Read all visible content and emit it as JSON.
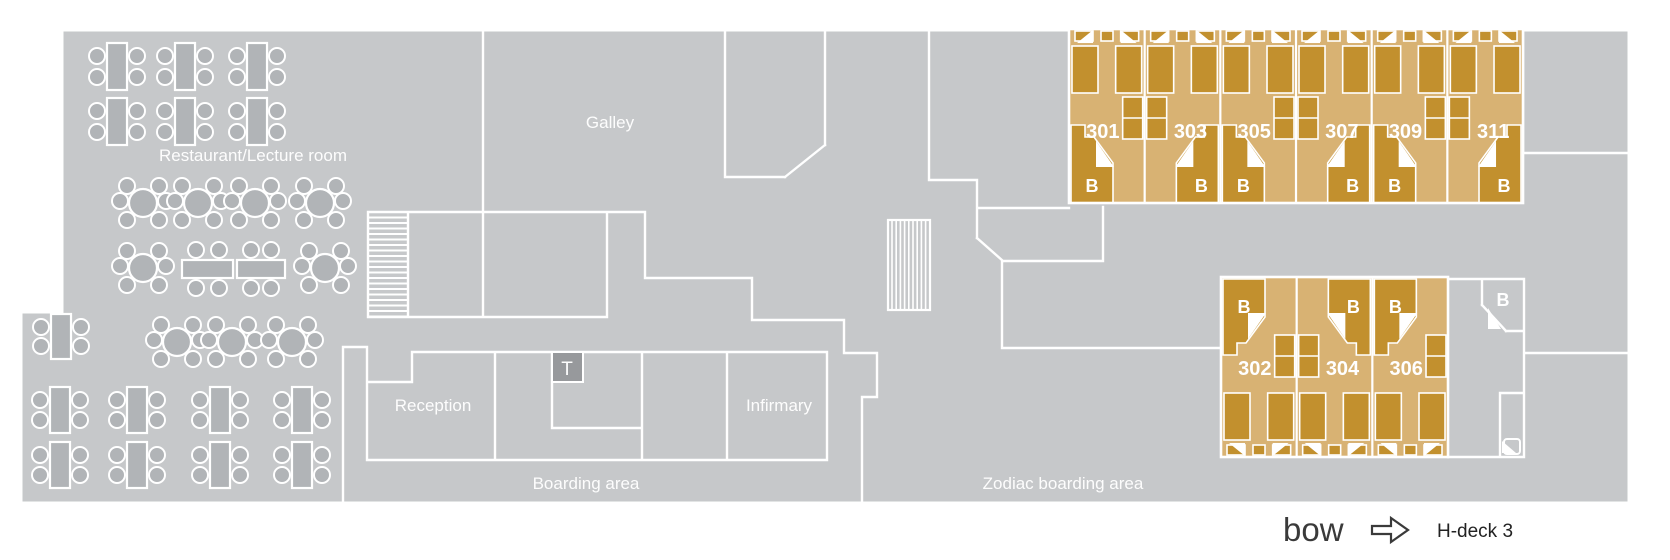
{
  "plan_title": "H-deck 3",
  "rooms": {
    "restaurant": "Restaurant/Lecture room",
    "galley": "Galley",
    "reception": "Reception",
    "toilet": "T",
    "infirmary": "Infirmary",
    "boarding": "Boarding area",
    "zodiac": "Zodiac boarding area"
  },
  "cabins": {
    "bathroom_label": "B",
    "top_row": [
      {
        "number": "301",
        "bath_side": "left",
        "table_side": "right"
      },
      {
        "number": "303",
        "bath_side": "right",
        "table_side": "left"
      },
      {
        "number": "305",
        "bath_side": "left",
        "table_side": "right"
      },
      {
        "number": "307",
        "bath_side": "right",
        "table_side": "left"
      },
      {
        "number": "309",
        "bath_side": "left",
        "table_side": "right"
      },
      {
        "number": "311",
        "bath_side": "right",
        "table_side": "left"
      }
    ],
    "bottom_row": [
      {
        "number": "302",
        "bath_side": "left",
        "table_side": "right"
      },
      {
        "number": "304",
        "bath_side": "right",
        "table_side": "left"
      },
      {
        "number": "306",
        "bath_side": "left",
        "table_side": "right"
      }
    ],
    "shared_bathroom_label": "B"
  },
  "footer": {
    "direction_label": "bow",
    "arrow_icon": "right-arrow",
    "deck_label": "H-deck 3"
  },
  "colors": {
    "deck": "#c6c8ca",
    "furniture": "#b1b4b7",
    "wall": "#ffffff",
    "cabin_bg": "#d8b273",
    "cabin_furniture": "#c2902e",
    "t_box": "#97999c",
    "footer_text": "#3a3a3a"
  }
}
